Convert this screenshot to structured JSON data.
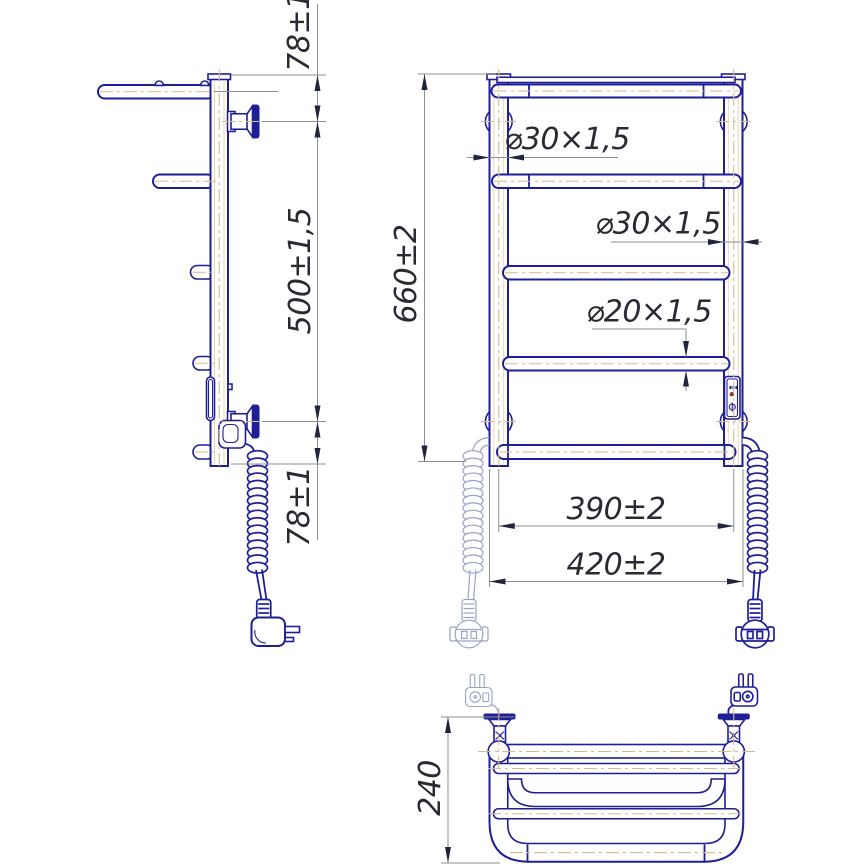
{
  "drawing": {
    "subject": "wall-mounted electric heated towel rail with top shelf, three orthographic views",
    "colors": {
      "outline_blue": "#1e1e96",
      "centerline_tan": "#d9b98e",
      "dimension_gray": "#8f8f8f",
      "text_dark": "#2a2a33",
      "phantom_gray_blue": "#9aa3c6",
      "indicator_red": "#993333",
      "background": "#ffffff"
    },
    "dimensions": {
      "side": {
        "top_offset": "78±1",
        "bracket_spacing": "500±1,5",
        "bottom_offset": "78±1"
      },
      "overall_height": "660±2",
      "left_stand_tube": "⌀30×1,5",
      "right_stand_tube": "⌀30×1,5",
      "rung_tube": "⌀20×1,5",
      "stand_spacing": "390±2",
      "overall_width": "420±2",
      "shelf_depth": "240"
    }
  }
}
